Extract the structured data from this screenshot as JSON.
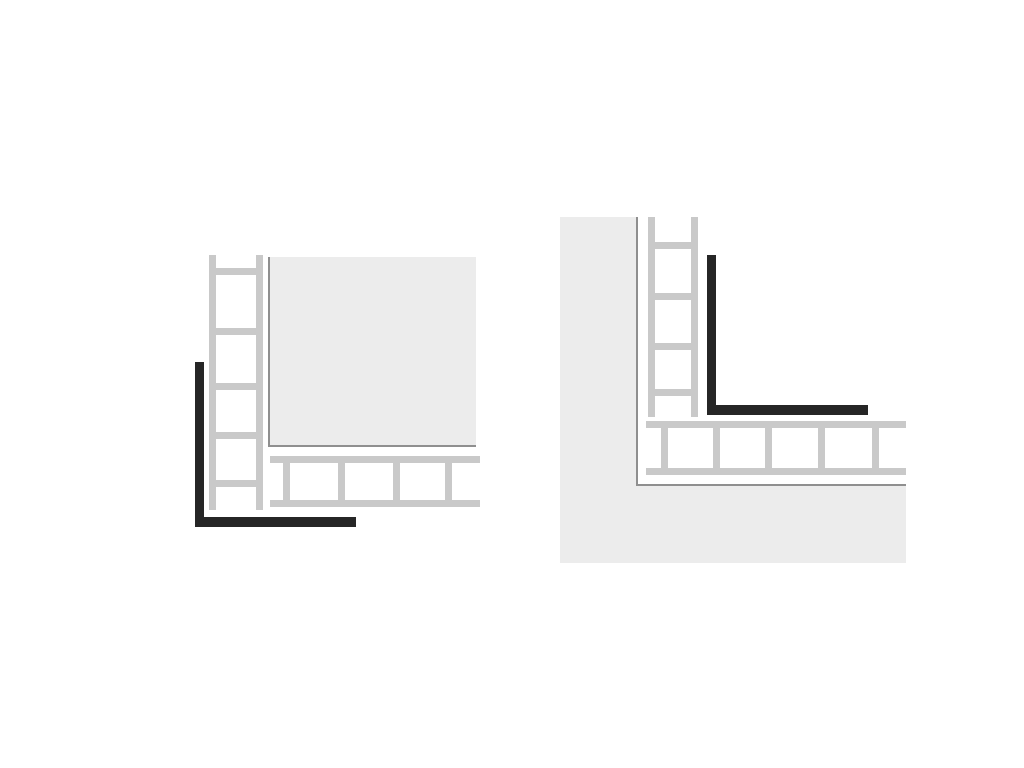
{
  "canvas": {
    "width": 1024,
    "height": 768,
    "background": "#ffffff"
  },
  "colors": {
    "mesh_gray": "#c9c9c9",
    "panel_fill": "#ececec",
    "edge_line": "#8f8f8f",
    "profile_black": "#262626"
  },
  "diagrams": [
    {
      "id": "outer-corner-detail",
      "description": "Corner profile applied to outer corner of tiled panel with mesh reinforcing strips",
      "shapes": [
        {
          "name": "tile-panel-fill",
          "x": 270,
          "y": 257,
          "w": 206,
          "h": 190,
          "color": "panel_fill"
        },
        {
          "name": "tile-panel-left-edge",
          "x": 268,
          "y": 257,
          "w": 2,
          "h": 190,
          "color": "edge_line"
        },
        {
          "name": "tile-panel-bottom-edge",
          "x": 268,
          "y": 445,
          "w": 208,
          "h": 2,
          "color": "edge_line"
        },
        {
          "name": "vertical-mesh-left-rail",
          "x": 209,
          "y": 255,
          "w": 7,
          "h": 255,
          "color": "mesh_gray"
        },
        {
          "name": "vertical-mesh-right-rail",
          "x": 256,
          "y": 255,
          "w": 7,
          "h": 255,
          "color": "mesh_gray"
        },
        {
          "name": "vertical-mesh-rung",
          "x": 209,
          "y": 268,
          "w": 54,
          "h": 7,
          "color": "mesh_gray"
        },
        {
          "name": "vertical-mesh-rung",
          "x": 209,
          "y": 328,
          "w": 54,
          "h": 7,
          "color": "mesh_gray"
        },
        {
          "name": "vertical-mesh-rung",
          "x": 209,
          "y": 383,
          "w": 54,
          "h": 7,
          "color": "mesh_gray"
        },
        {
          "name": "vertical-mesh-rung",
          "x": 209,
          "y": 432,
          "w": 54,
          "h": 7,
          "color": "mesh_gray"
        },
        {
          "name": "vertical-mesh-rung",
          "x": 209,
          "y": 480,
          "w": 54,
          "h": 7,
          "color": "mesh_gray"
        },
        {
          "name": "horizontal-mesh-top-rail",
          "x": 270,
          "y": 456,
          "w": 210,
          "h": 7,
          "color": "mesh_gray"
        },
        {
          "name": "horizontal-mesh-bottom-rail",
          "x": 270,
          "y": 500,
          "w": 210,
          "h": 7,
          "color": "mesh_gray"
        },
        {
          "name": "horizontal-mesh-rung",
          "x": 283,
          "y": 456,
          "w": 7,
          "h": 51,
          "color": "mesh_gray"
        },
        {
          "name": "horizontal-mesh-rung",
          "x": 338,
          "y": 456,
          "w": 7,
          "h": 51,
          "color": "mesh_gray"
        },
        {
          "name": "horizontal-mesh-rung",
          "x": 393,
          "y": 456,
          "w": 7,
          "h": 51,
          "color": "mesh_gray"
        },
        {
          "name": "horizontal-mesh-rung",
          "x": 445,
          "y": 456,
          "w": 7,
          "h": 51,
          "color": "mesh_gray"
        },
        {
          "name": "corner-profile-vertical-leg",
          "x": 195,
          "y": 362,
          "w": 9,
          "h": 165,
          "color": "profile_black"
        },
        {
          "name": "corner-profile-horizontal-leg",
          "x": 195,
          "y": 517,
          "w": 161,
          "h": 10,
          "color": "profile_black"
        }
      ]
    },
    {
      "id": "inner-corner-detail",
      "description": "Corner profile applied to inner corner of L-shaped wall section with mesh reinforcing strips",
      "shapes": [
        {
          "name": "wall-vertical-fill",
          "x": 560,
          "y": 217,
          "w": 76,
          "h": 346,
          "color": "panel_fill"
        },
        {
          "name": "wall-horizontal-fill",
          "x": 636,
          "y": 486,
          "w": 270,
          "h": 77,
          "color": "panel_fill"
        },
        {
          "name": "wall-inner-vertical-edge",
          "x": 636,
          "y": 217,
          "w": 2,
          "h": 269,
          "color": "edge_line"
        },
        {
          "name": "wall-inner-horizontal-edge",
          "x": 636,
          "y": 484,
          "w": 270,
          "h": 2,
          "color": "edge_line"
        },
        {
          "name": "vertical-mesh-left-rail",
          "x": 648,
          "y": 217,
          "w": 7,
          "h": 200,
          "color": "mesh_gray"
        },
        {
          "name": "vertical-mesh-right-rail",
          "x": 691,
          "y": 217,
          "w": 7,
          "h": 200,
          "color": "mesh_gray"
        },
        {
          "name": "vertical-mesh-rung",
          "x": 648,
          "y": 242,
          "w": 50,
          "h": 7,
          "color": "mesh_gray"
        },
        {
          "name": "vertical-mesh-rung",
          "x": 648,
          "y": 293,
          "w": 50,
          "h": 7,
          "color": "mesh_gray"
        },
        {
          "name": "vertical-mesh-rung",
          "x": 648,
          "y": 343,
          "w": 50,
          "h": 7,
          "color": "mesh_gray"
        },
        {
          "name": "vertical-mesh-rung",
          "x": 648,
          "y": 389,
          "w": 50,
          "h": 7,
          "color": "mesh_gray"
        },
        {
          "name": "horizontal-mesh-top-rail",
          "x": 646,
          "y": 421,
          "w": 260,
          "h": 7,
          "color": "mesh_gray"
        },
        {
          "name": "horizontal-mesh-bottom-rail",
          "x": 646,
          "y": 468,
          "w": 260,
          "h": 7,
          "color": "mesh_gray"
        },
        {
          "name": "horizontal-mesh-rung",
          "x": 661,
          "y": 421,
          "w": 7,
          "h": 54,
          "color": "mesh_gray"
        },
        {
          "name": "horizontal-mesh-rung",
          "x": 713,
          "y": 421,
          "w": 7,
          "h": 54,
          "color": "mesh_gray"
        },
        {
          "name": "horizontal-mesh-rung",
          "x": 765,
          "y": 421,
          "w": 7,
          "h": 54,
          "color": "mesh_gray"
        },
        {
          "name": "horizontal-mesh-rung",
          "x": 818,
          "y": 421,
          "w": 7,
          "h": 54,
          "color": "mesh_gray"
        },
        {
          "name": "horizontal-mesh-rung",
          "x": 872,
          "y": 421,
          "w": 7,
          "h": 54,
          "color": "mesh_gray"
        },
        {
          "name": "corner-profile-vertical-leg",
          "x": 707,
          "y": 255,
          "w": 9,
          "h": 160,
          "color": "profile_black"
        },
        {
          "name": "corner-profile-horizontal-leg",
          "x": 707,
          "y": 405,
          "w": 161,
          "h": 10,
          "color": "profile_black"
        }
      ]
    }
  ]
}
